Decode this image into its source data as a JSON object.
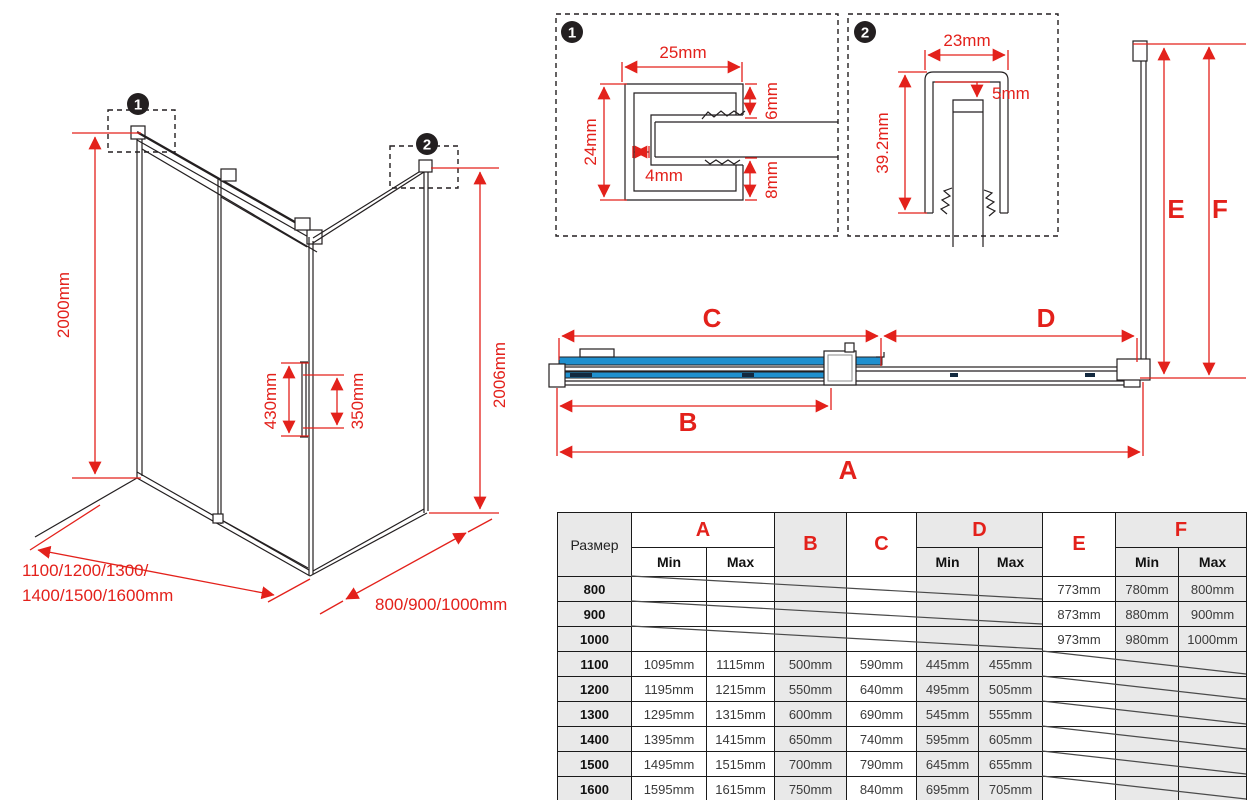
{
  "colors": {
    "red": "#e3211b",
    "blue": "#1f90cf",
    "navy": "#13293f",
    "line": "#231f20",
    "gray_fill": "#e9e9e9"
  },
  "badges": {
    "one": "1",
    "two": "2"
  },
  "dim_letters": {
    "a": "A",
    "b": "B",
    "c": "C",
    "d": "D",
    "e": "E",
    "f": "F"
  },
  "iso": {
    "height_left": "2000mm",
    "height_right": "2006mm",
    "handle_height": "430mm",
    "handle_span": "350mm",
    "front_widths_line1": "1100/1200/1300/",
    "front_widths_line2": "1400/1500/1600mm",
    "side_widths": "800/900/1000mm"
  },
  "detail1": {
    "width": "25mm",
    "height": "24mm",
    "step": "4mm",
    "gap_top": "6mm",
    "gap_bottom": "8mm"
  },
  "detail2": {
    "width": "23mm",
    "inset": "5mm",
    "height": "39.2mm"
  },
  "table": {
    "size_header": "Размер",
    "min_label": "Min",
    "max_label": "Max",
    "rows": [
      {
        "size": "800",
        "a_min": "",
        "a_max": "",
        "b": "",
        "c": "",
        "d_min": "",
        "d_max": "",
        "e": "773mm",
        "f_min": "780mm",
        "f_max": "800mm"
      },
      {
        "size": "900",
        "a_min": "",
        "a_max": "",
        "b": "",
        "c": "",
        "d_min": "",
        "d_max": "",
        "e": "873mm",
        "f_min": "880mm",
        "f_max": "900mm"
      },
      {
        "size": "1000",
        "a_min": "",
        "a_max": "",
        "b": "",
        "c": "",
        "d_min": "",
        "d_max": "",
        "e": "973mm",
        "f_min": "980mm",
        "f_max": "1000mm"
      },
      {
        "size": "1100",
        "a_min": "1095mm",
        "a_max": "1115mm",
        "b": "500mm",
        "c": "590mm",
        "d_min": "445mm",
        "d_max": "455mm",
        "e": "",
        "f_min": "",
        "f_max": ""
      },
      {
        "size": "1200",
        "a_min": "1195mm",
        "a_max": "1215mm",
        "b": "550mm",
        "c": "640mm",
        "d_min": "495mm",
        "d_max": "505mm",
        "e": "",
        "f_min": "",
        "f_max": ""
      },
      {
        "size": "1300",
        "a_min": "1295mm",
        "a_max": "1315mm",
        "b": "600mm",
        "c": "690mm",
        "d_min": "545mm",
        "d_max": "555mm",
        "e": "",
        "f_min": "",
        "f_max": ""
      },
      {
        "size": "1400",
        "a_min": "1395mm",
        "a_max": "1415mm",
        "b": "650mm",
        "c": "740mm",
        "d_min": "595mm",
        "d_max": "605mm",
        "e": "",
        "f_min": "",
        "f_max": ""
      },
      {
        "size": "1500",
        "a_min": "1495mm",
        "a_max": "1515mm",
        "b": "700mm",
        "c": "790mm",
        "d_min": "645mm",
        "d_max": "655mm",
        "e": "",
        "f_min": "",
        "f_max": ""
      },
      {
        "size": "1600",
        "a_min": "1595mm",
        "a_max": "1615mm",
        "b": "750mm",
        "c": "840mm",
        "d_min": "695mm",
        "d_max": "705mm",
        "e": "",
        "f_min": "",
        "f_max": ""
      }
    ]
  }
}
